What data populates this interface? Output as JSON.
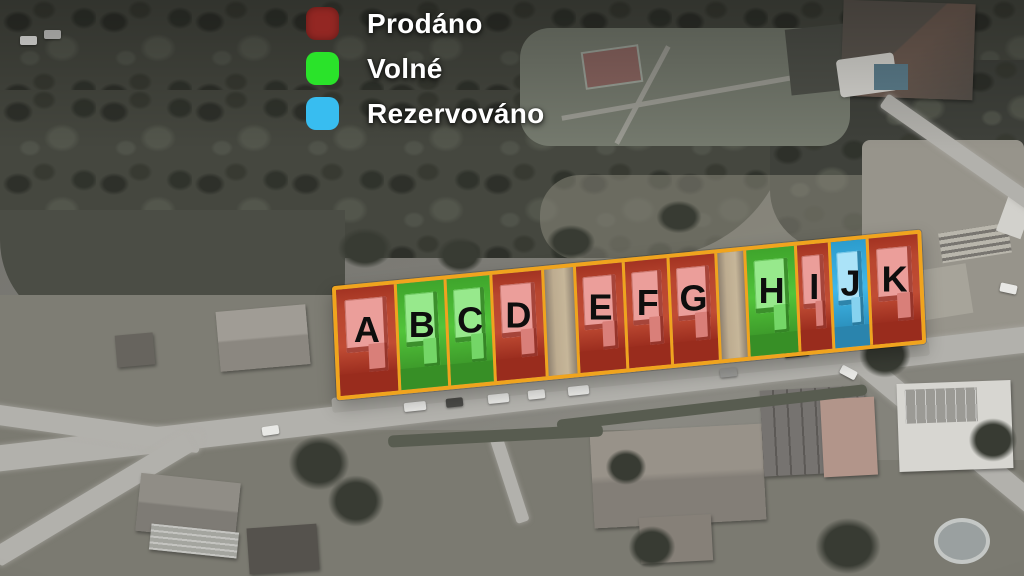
{
  "legend": {
    "items": [
      {
        "id": "sold",
        "label": "Prodáno",
        "color": "#932723"
      },
      {
        "id": "available",
        "label": "Volné",
        "color": "#2ae32a"
      },
      {
        "id": "reserved",
        "label": "Rezervováno",
        "color": "#38bdf0"
      }
    ]
  },
  "lots": [
    {
      "label": "A",
      "status": "sold"
    },
    {
      "label": "B",
      "status": "available"
    },
    {
      "label": "C",
      "status": "available"
    },
    {
      "label": "D",
      "status": "sold"
    },
    {
      "label": "",
      "status": "access"
    },
    {
      "label": "E",
      "status": "sold"
    },
    {
      "label": "F",
      "status": "sold"
    },
    {
      "label": "G",
      "status": "sold"
    },
    {
      "label": "",
      "status": "access"
    },
    {
      "label": "H",
      "status": "available"
    },
    {
      "label": "I",
      "status": "sold"
    },
    {
      "label": "J",
      "status": "reserved"
    },
    {
      "label": "K",
      "status": "sold"
    }
  ],
  "status_colors": {
    "sold_fill": "#bb4630",
    "available_fill": "#4cc038",
    "reserved_fill": "#3cb3e4",
    "lot_outline": "#f0a41e"
  }
}
